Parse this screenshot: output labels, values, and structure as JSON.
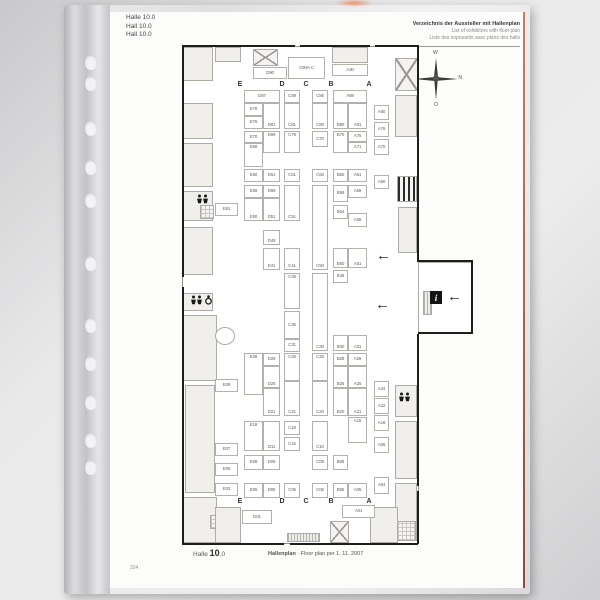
{
  "page": {
    "header_left": [
      "Halle 10.0",
      "Hall 10.0",
      "Hall 10.0"
    ],
    "header_right": [
      "Verzeichnis der Aussteller mit Hallenplan",
      "List of exhibitors with floor plan",
      "Liste des exposants avec plans des halls"
    ],
    "footer": {
      "hall_label": "Halle",
      "hall_number": "10",
      "hall_suffix": ".0",
      "plan_label": "Hallenplan",
      "plan_caption": "· Floor plan per 1. 11. 2007",
      "page_number": "324"
    }
  },
  "compass": {
    "top": "W",
    "left": "S",
    "right": "N",
    "bottom": "O"
  },
  "plan": {
    "aisles": {
      "letters": [
        "E",
        "D",
        "C",
        "B",
        "A"
      ],
      "xs": [
        70,
        112,
        136,
        161,
        199
      ],
      "top_y": 36,
      "bottom_y": 453
    },
    "booths": [
      [
        "D90",
        83,
        22,
        34,
        12,
        ""
      ],
      [
        "C90A-C",
        118,
        12,
        37,
        22,
        ""
      ],
      [
        "A30",
        162,
        19,
        36,
        12,
        ""
      ],
      [
        "D87",
        74,
        45,
        36,
        13,
        ""
      ],
      [
        "C89",
        114,
        45,
        16,
        13,
        ""
      ],
      [
        "C86",
        142,
        45,
        16,
        13,
        ""
      ],
      [
        "A89",
        163,
        45,
        34,
        13,
        ""
      ],
      [
        "E78",
        74,
        58,
        19,
        13,
        ""
      ],
      [
        "E76",
        74,
        71,
        19,
        13,
        ""
      ],
      [
        "D81",
        93,
        58,
        17,
        26,
        "b"
      ],
      [
        "C81",
        114,
        58,
        16,
        26,
        "b"
      ],
      [
        "C80",
        142,
        58,
        16,
        26,
        "b"
      ],
      [
        "B80",
        163,
        58,
        15,
        26,
        "b"
      ],
      [
        "A81",
        178,
        58,
        19,
        26,
        "b"
      ],
      [
        "A80",
        204,
        60,
        15,
        15,
        ""
      ],
      [
        "E70",
        74,
        86,
        19,
        12,
        ""
      ],
      [
        "E68",
        74,
        98,
        19,
        24,
        "t"
      ],
      [
        "D69",
        93,
        86,
        17,
        22,
        "t"
      ],
      [
        "C79",
        114,
        86,
        16,
        22,
        "t"
      ],
      [
        "C70",
        142,
        86,
        16,
        16,
        ""
      ],
      [
        "B70",
        163,
        86,
        15,
        22,
        "t"
      ],
      [
        "A75",
        178,
        86,
        19,
        11,
        ""
      ],
      [
        "A71",
        178,
        97,
        19,
        11,
        ""
      ],
      [
        "A76",
        204,
        77,
        15,
        15,
        ""
      ],
      [
        "A70",
        204,
        94,
        15,
        16,
        ""
      ],
      [
        "E60",
        74,
        124,
        19,
        13,
        ""
      ],
      [
        "D61",
        93,
        124,
        17,
        13,
        ""
      ],
      [
        "C61",
        114,
        124,
        16,
        13,
        ""
      ],
      [
        "C60",
        142,
        124,
        16,
        13,
        ""
      ],
      [
        "B60",
        163,
        124,
        15,
        13,
        ""
      ],
      [
        "A61",
        178,
        124,
        19,
        13,
        ""
      ],
      [
        "A60",
        204,
        130,
        15,
        14,
        ""
      ],
      [
        "E58",
        74,
        140,
        19,
        13,
        ""
      ],
      [
        "D59",
        93,
        140,
        17,
        13,
        ""
      ],
      [
        "B58",
        163,
        140,
        15,
        17,
        ""
      ],
      [
        "A59",
        178,
        140,
        19,
        13,
        ""
      ],
      [
        "E61",
        45,
        158,
        23,
        13,
        ""
      ],
      [
        "E50",
        74,
        153,
        19,
        23,
        "b"
      ],
      [
        "D51",
        93,
        153,
        17,
        23,
        "b"
      ],
      [
        "C51",
        114,
        140,
        16,
        36,
        "b"
      ],
      [
        "B54",
        163,
        160,
        15,
        14,
        ""
      ],
      [
        "A55",
        178,
        168,
        19,
        14,
        ""
      ],
      [
        "D49",
        93,
        185,
        17,
        15,
        "b"
      ],
      [
        "D41",
        93,
        203,
        17,
        22,
        "b"
      ],
      [
        "C41",
        114,
        203,
        16,
        22,
        "b"
      ],
      [
        "C50",
        142,
        140,
        16,
        85,
        "b"
      ],
      [
        "B50",
        163,
        203,
        15,
        20,
        "b"
      ],
      [
        "A51",
        178,
        203,
        19,
        20,
        "b"
      ],
      [
        "B48",
        163,
        225,
        15,
        13,
        ""
      ],
      [
        "C39",
        114,
        228,
        16,
        36,
        "t"
      ],
      [
        "C35",
        114,
        266,
        16,
        28,
        ""
      ],
      [
        "C31",
        114,
        294,
        16,
        13,
        ""
      ],
      [
        "C30",
        142,
        228,
        16,
        78,
        "b"
      ],
      [
        "B30",
        163,
        290,
        15,
        16,
        "b"
      ],
      [
        "A31",
        178,
        290,
        19,
        16,
        "b"
      ],
      [
        "E28",
        74,
        308,
        19,
        42,
        "t"
      ],
      [
        "D29",
        93,
        308,
        17,
        13,
        ""
      ],
      [
        "D25",
        93,
        321,
        17,
        22,
        "b"
      ],
      [
        "D21",
        93,
        343,
        17,
        28,
        "b"
      ],
      [
        "C29",
        114,
        308,
        16,
        28,
        "t"
      ],
      [
        "C21",
        114,
        336,
        16,
        35,
        "b"
      ],
      [
        "C28",
        142,
        308,
        16,
        28,
        "t"
      ],
      [
        "C20",
        142,
        336,
        16,
        35,
        "b"
      ],
      [
        "B28",
        163,
        308,
        15,
        13,
        ""
      ],
      [
        "B26",
        163,
        321,
        15,
        22,
        "b"
      ],
      [
        "B20",
        163,
        343,
        15,
        28,
        "b"
      ],
      [
        "A29",
        178,
        308,
        19,
        13,
        ""
      ],
      [
        "A25",
        178,
        321,
        19,
        22,
        "b"
      ],
      [
        "A21",
        178,
        343,
        19,
        28,
        "b"
      ],
      [
        "A24",
        204,
        336,
        15,
        16,
        ""
      ],
      [
        "A22",
        204,
        353,
        15,
        16,
        ""
      ],
      [
        "A18",
        204,
        370,
        15,
        16,
        ""
      ],
      [
        "A06",
        204,
        392,
        15,
        16,
        ""
      ],
      [
        "A04",
        204,
        432,
        15,
        17,
        ""
      ],
      [
        "E18",
        74,
        376,
        19,
        30,
        "t"
      ],
      [
        "D11",
        93,
        376,
        17,
        30,
        "b"
      ],
      [
        "C19",
        114,
        376,
        16,
        14,
        ""
      ],
      [
        "C15",
        114,
        392,
        16,
        14,
        ""
      ],
      [
        "C10",
        142,
        376,
        16,
        30,
        "b"
      ],
      [
        "A15",
        178,
        372,
        19,
        26,
        "t"
      ],
      [
        "E09",
        45,
        334,
        23,
        13,
        ""
      ],
      [
        "E07",
        45,
        398,
        23,
        13,
        ""
      ],
      [
        "E05",
        45,
        418,
        23,
        13,
        ""
      ],
      [
        "E03",
        45,
        438,
        23,
        13,
        ""
      ],
      [
        "E08",
        74,
        410,
        19,
        15,
        ""
      ],
      [
        "D09",
        93,
        410,
        17,
        15,
        ""
      ],
      [
        "C08",
        142,
        410,
        16,
        15,
        ""
      ],
      [
        "B08",
        163,
        410,
        15,
        15,
        ""
      ],
      [
        "E06",
        74,
        438,
        19,
        15,
        ""
      ],
      [
        "D05",
        93,
        438,
        17,
        15,
        ""
      ],
      [
        "C05",
        114,
        438,
        16,
        15,
        ""
      ],
      [
        "C06",
        142,
        438,
        16,
        15,
        ""
      ],
      [
        "B06",
        163,
        438,
        15,
        15,
        ""
      ],
      [
        "A05",
        178,
        438,
        19,
        15,
        ""
      ],
      [
        "D01",
        72,
        465,
        30,
        14,
        ""
      ],
      [
        "A01",
        172,
        460,
        33,
        13,
        ""
      ]
    ],
    "structures": [
      [
        13,
        2,
        30,
        34,
        "room"
      ],
      [
        45,
        2,
        26,
        15,
        "room"
      ],
      [
        83,
        4,
        25,
        17,
        "x"
      ],
      [
        162,
        2,
        36,
        16,
        "room"
      ],
      [
        225,
        13,
        23,
        33,
        "x"
      ],
      [
        13,
        58,
        30,
        36,
        "room"
      ],
      [
        13,
        98,
        30,
        44,
        "room"
      ],
      [
        13,
        146,
        30,
        30,
        "room"
      ],
      [
        30,
        160,
        14,
        14,
        "grid"
      ],
      [
        13,
        182,
        30,
        48,
        "room"
      ],
      [
        13,
        248,
        30,
        18,
        "room"
      ],
      [
        13,
        270,
        34,
        66,
        "room"
      ],
      [
        45,
        282,
        20,
        18,
        "circle"
      ],
      [
        15,
        340,
        30,
        108,
        "room"
      ],
      [
        13,
        452,
        34,
        46,
        "room"
      ],
      [
        40,
        470,
        16,
        14,
        "grid"
      ],
      [
        225,
        50,
        22,
        42,
        "room"
      ],
      [
        227,
        131,
        20,
        26,
        "bars"
      ],
      [
        228,
        162,
        19,
        46,
        "room"
      ],
      [
        248,
        217,
        54,
        72,
        "open"
      ],
      [
        253,
        246,
        9,
        24,
        "hatch"
      ],
      [
        225,
        340,
        22,
        32,
        "room"
      ],
      [
        225,
        376,
        22,
        58,
        "room"
      ],
      [
        225,
        438,
        22,
        58,
        "room"
      ],
      [
        45,
        462,
        26,
        36,
        "room"
      ],
      [
        117,
        488,
        33,
        9,
        "hatch"
      ],
      [
        160,
        476,
        19,
        22,
        "x"
      ],
      [
        200,
        462,
        28,
        36,
        "room"
      ],
      [
        227,
        476,
        19,
        20,
        "grid"
      ]
    ],
    "walls": [
      [
        13,
        0,
        112,
        2
      ],
      [
        130,
        0,
        70,
        2
      ],
      [
        205,
        0,
        43,
        2
      ],
      [
        12,
        498,
        102,
        2
      ],
      [
        120,
        498,
        128,
        2
      ],
      [
        12,
        0,
        2,
        232
      ],
      [
        12,
        242,
        2,
        257
      ],
      [
        247,
        0,
        2,
        217
      ],
      [
        247,
        289,
        2,
        152
      ],
      [
        247,
        446,
        2,
        53
      ],
      [
        248,
        215,
        54,
        2
      ],
      [
        248,
        287,
        54,
        2
      ],
      [
        301,
        215,
        2,
        74
      ]
    ],
    "icons": [
      [
        "wc2",
        26,
        149,
        ""
      ],
      [
        "wc3",
        20,
        250,
        ""
      ],
      [
        "wc2",
        228,
        347,
        ""
      ],
      [
        "info",
        260,
        246,
        "i"
      ],
      [
        "arrowL",
        206,
        206,
        "←"
      ],
      [
        "arrowL",
        205,
        255,
        "←"
      ],
      [
        "arrowL",
        277,
        247,
        "←"
      ]
    ]
  }
}
